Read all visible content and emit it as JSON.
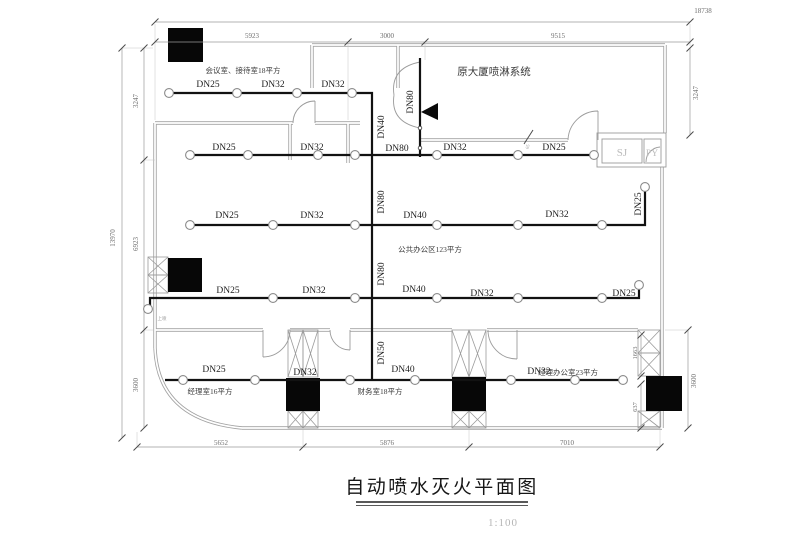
{
  "meta": {
    "title": "自动喷水灭火平面图",
    "scale": "1:100",
    "drawing_type": "fire-sprinkler-floor-plan"
  },
  "texts": {
    "dims": [
      {
        "n": "dim-top-total",
        "t": "18738",
        "x": 703,
        "y": 13
      },
      {
        "n": "dim-top-1",
        "t": "5923",
        "x": 252,
        "y": 38
      },
      {
        "n": "dim-top-2",
        "t": "3000",
        "x": 387,
        "y": 38
      },
      {
        "n": "dim-top-3",
        "t": "9515",
        "x": 558,
        "y": 38
      },
      {
        "n": "dim-left-total",
        "t": "13970",
        "x": 115,
        "y": 238,
        "r": -90
      },
      {
        "n": "dim-left-1",
        "t": "3247",
        "x": 138,
        "y": 101,
        "r": -90
      },
      {
        "n": "dim-left-2",
        "t": "6923",
        "x": 138,
        "y": 244,
        "r": -90
      },
      {
        "n": "dim-left-3",
        "t": "3600",
        "x": 138,
        "y": 385,
        "r": -90
      },
      {
        "n": "dim-right-top",
        "t": "3247",
        "x": 698,
        "y": 93,
        "r": -90
      },
      {
        "n": "dim-right-1663",
        "t": "1663",
        "x": 637,
        "y": 353,
        "r": -90,
        "s": 6.5
      },
      {
        "n": "dim-right-637",
        "t": "637",
        "x": 637,
        "y": 407,
        "r": -90,
        "s": 6.5
      },
      {
        "n": "dim-right-3600",
        "t": "3600",
        "x": 696,
        "y": 381,
        "r": -90
      },
      {
        "n": "dim-bottom-1",
        "t": "5652",
        "x": 221,
        "y": 445
      },
      {
        "n": "dim-bottom-2",
        "t": "5876",
        "x": 387,
        "y": 445
      },
      {
        "n": "dim-bottom-3",
        "t": "7010",
        "x": 567,
        "y": 445
      }
    ],
    "pipes": [
      {
        "t": "DN25",
        "x": 208,
        "y": 87
      },
      {
        "t": "DN32",
        "x": 273,
        "y": 87
      },
      {
        "t": "DN32",
        "x": 333,
        "y": 87
      },
      {
        "t": "DN25",
        "x": 224,
        "y": 150
      },
      {
        "t": "DN32",
        "x": 312,
        "y": 150
      },
      {
        "t": "DN80",
        "x": 397,
        "y": 151
      },
      {
        "t": "DN32",
        "x": 455,
        "y": 150
      },
      {
        "t": "DN25",
        "x": 554,
        "y": 150
      },
      {
        "t": "DN25",
        "x": 227,
        "y": 218
      },
      {
        "t": "DN32",
        "x": 312,
        "y": 218
      },
      {
        "t": "DN40",
        "x": 415,
        "y": 218
      },
      {
        "t": "DN32",
        "x": 557,
        "y": 217
      },
      {
        "t": "DN25",
        "x": 641,
        "y": 204,
        "r": -90
      },
      {
        "t": "DN25",
        "x": 228,
        "y": 293
      },
      {
        "t": "DN32",
        "x": 314,
        "y": 293
      },
      {
        "t": "DN40",
        "x": 414,
        "y": 292
      },
      {
        "t": "DN32",
        "x": 482,
        "y": 296
      },
      {
        "t": "DN25",
        "x": 624,
        "y": 296
      },
      {
        "t": "DN25",
        "x": 214,
        "y": 372
      },
      {
        "t": "DN32",
        "x": 305,
        "y": 375
      },
      {
        "t": "DN40",
        "x": 403,
        "y": 372
      },
      {
        "t": "DN32",
        "x": 539,
        "y": 374
      },
      {
        "t": "DN40",
        "x": 384,
        "y": 127,
        "r": -90
      },
      {
        "t": "DN80",
        "x": 413,
        "y": 102,
        "r": -90
      },
      {
        "t": "DN80",
        "x": 384,
        "y": 202,
        "r": -90
      },
      {
        "t": "DN80",
        "x": 384,
        "y": 274,
        "r": -90
      },
      {
        "t": "DN50",
        "x": 384,
        "y": 353,
        "r": -90
      }
    ],
    "rooms": [
      {
        "n": "room-label-meeting",
        "t": "会议室、接待室18平方",
        "x": 243,
        "y": 73
      },
      {
        "n": "room-label-public",
        "t": "公共办公区123平方",
        "x": 430,
        "y": 252
      },
      {
        "n": "room-label-manager",
        "t": "经理室16平方",
        "x": 210,
        "y": 394
      },
      {
        "n": "room-label-finance",
        "t": "财务室18平方",
        "x": 380,
        "y": 394
      },
      {
        "n": "room-label-office",
        "t": "经理办公室23平方",
        "x": 568,
        "y": 375
      }
    ],
    "misc": [
      {
        "n": "source-system-label",
        "t": "原大厦喷淋系统",
        "x": 494,
        "y": 75,
        "s": 10.5,
        "c": "#3a3a3a"
      },
      {
        "n": "shaft-label-sj",
        "t": "SJ",
        "x": 622,
        "y": 156,
        "s": 11,
        "c": "#bcbcbc"
      },
      {
        "n": "shaft-label-py",
        "t": "PY",
        "x": 652,
        "y": 156,
        "s": 9.5,
        "c": "#bcbcbc"
      },
      {
        "n": "tiny-note-1",
        "t": "上喷",
        "x": 162,
        "y": 320,
        "s": 4.5,
        "c": "#9a9a9a"
      },
      {
        "n": "tiny-note-2",
        "t": "65",
        "x": 529,
        "y": 147,
        "s": 4.5,
        "c": "#9a9a9a",
        "r": -75
      }
    ]
  },
  "sprinklers": [
    [
      169,
      93
    ],
    [
      237,
      93
    ],
    [
      297,
      93
    ],
    [
      352,
      93
    ],
    [
      190,
      155
    ],
    [
      248,
      155
    ],
    [
      318,
      155
    ],
    [
      355,
      155
    ],
    [
      437,
      155
    ],
    [
      518,
      155
    ],
    [
      594,
      155
    ],
    [
      190,
      225
    ],
    [
      273,
      225
    ],
    [
      355,
      225
    ],
    [
      437,
      225
    ],
    [
      518,
      225
    ],
    [
      602,
      225
    ],
    [
      645,
      187
    ],
    [
      148,
      309
    ],
    [
      273,
      298
    ],
    [
      355,
      298
    ],
    [
      437,
      298
    ],
    [
      518,
      298
    ],
    [
      602,
      298
    ],
    [
      639,
      285
    ],
    [
      183,
      380
    ],
    [
      255,
      380
    ],
    [
      350,
      380
    ],
    [
      415,
      380
    ],
    [
      511,
      380
    ],
    [
      575,
      380
    ],
    [
      623,
      380
    ]
  ]
}
